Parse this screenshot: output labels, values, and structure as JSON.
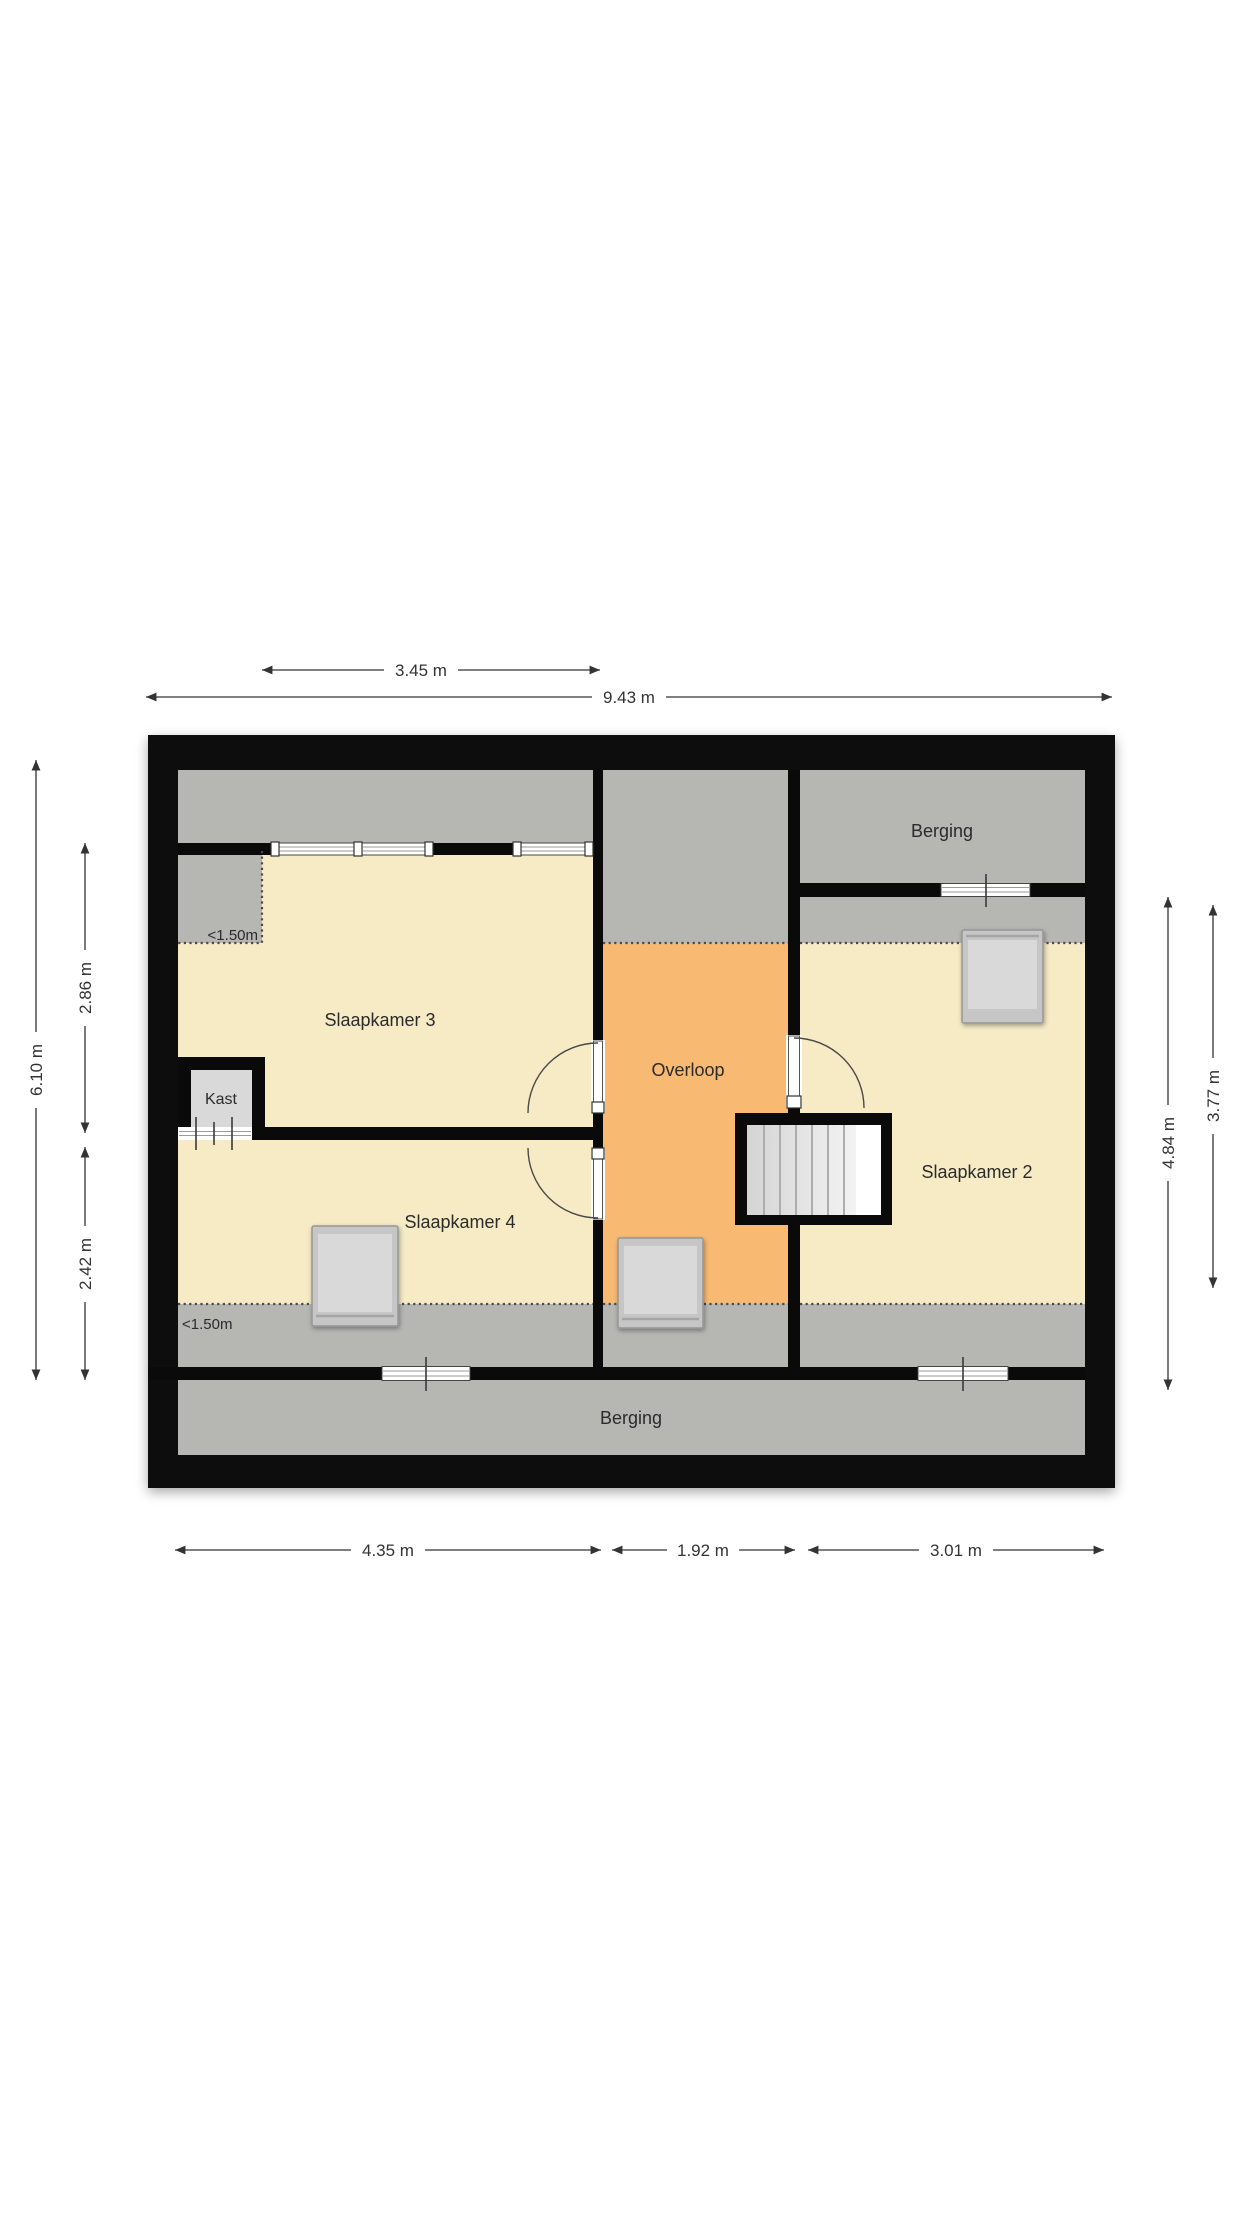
{
  "floorplan": {
    "rooms": {
      "slaapkamer3": {
        "label": "Slaapkamer 3"
      },
      "slaapkamer4": {
        "label": "Slaapkamer 4"
      },
      "slaapkamer2": {
        "label": "Slaapkamer 2"
      },
      "overloop": {
        "label": "Overloop"
      },
      "kast": {
        "label": "Kast"
      },
      "berging_top": {
        "label": "Berging"
      },
      "berging_bottom": {
        "label": "Berging"
      }
    },
    "annotations": {
      "low_headroom_top": "<1.50m",
      "low_headroom_bottom": "<1.50m"
    },
    "dimensions": {
      "top_section": "3.45 m",
      "top_total": "9.43 m",
      "left_total": "6.10 m",
      "left_upper": "2.86 m",
      "left_lower": "2.42 m",
      "right_total": "4.84 m",
      "right_section": "3.77 m",
      "bottom_left": "4.35 m",
      "bottom_center": "1.92 m",
      "bottom_right": "3.01 m"
    },
    "colors": {
      "wall": "#0a0a0a",
      "room_yellow": "#f6ebc5",
      "hallway_orange": "#f8ba72",
      "low_zone_gray": "#b6b6b3",
      "closet_gray": "#d9d9d9",
      "background": "#ffffff"
    }
  }
}
